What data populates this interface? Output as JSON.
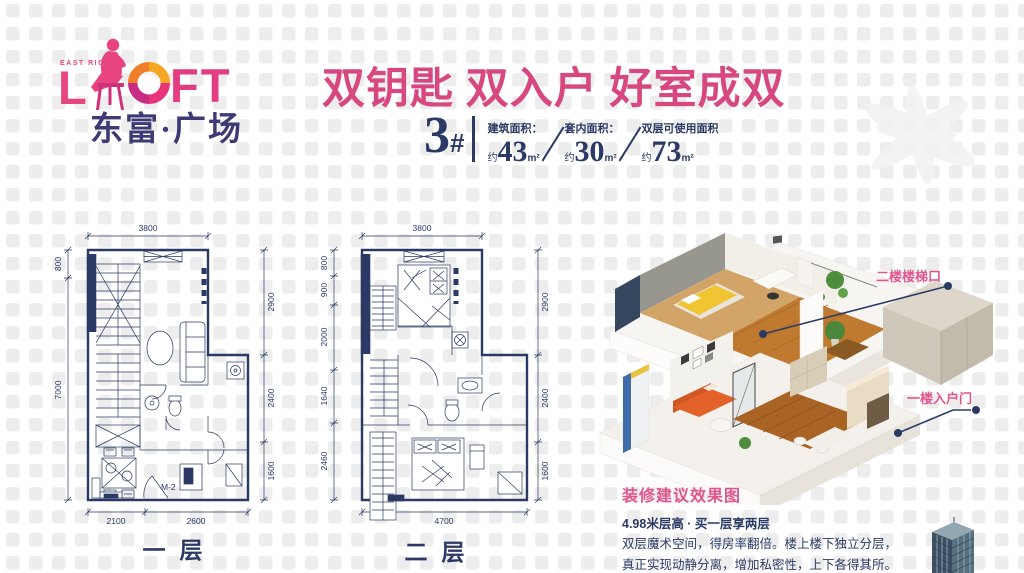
{
  "brand": {
    "east_rich": "EAST RICH",
    "loft_l": "L",
    "loft_o": "O",
    "loft_ft": "FT",
    "name_cn": "东富·广场"
  },
  "header": {
    "title": "双钥匙 双入户 好室成双",
    "unit_number": "3",
    "unit_hash": "#",
    "stats": [
      {
        "label": "建筑面积：",
        "prefix": "约",
        "value": "43",
        "unit": "m²"
      },
      {
        "label": "套内面积：",
        "prefix": "约",
        "value": "30",
        "unit": "m²"
      },
      {
        "label": "双层可使用面积",
        "prefix": "约",
        "value": "73",
        "unit": "m²"
      }
    ]
  },
  "floorplans": [
    {
      "name": "一层",
      "door_label": "M-2",
      "dims": {
        "top": "3800",
        "left": [
          "800",
          "7000"
        ],
        "right": [
          "2900",
          "2400",
          "1600"
        ],
        "bottom": [
          "2100",
          "2600"
        ]
      }
    },
    {
      "name": "二层",
      "dims": {
        "top": "3800",
        "left": [
          "800",
          "900",
          "2000",
          "1640",
          "2460"
        ],
        "right": [
          "2900",
          "2400",
          "1600"
        ],
        "bottom": [
          "4700"
        ]
      }
    }
  ],
  "render": {
    "callout_upper": "二楼楼梯口",
    "callout_lower": "一楼入户门",
    "caption_title": "装修建议效果图",
    "caption_subtitle": "4.98米层高 · 买一层享两层",
    "caption_line1": "双层魔术空间，得房率翻倍。楼上楼下独立分层，",
    "caption_line2": "真正实现动静分离，增加私密性，上下各得其所。"
  },
  "colors": {
    "navy": "#2b3a64",
    "title_pink": "#d6487f",
    "accent_pink": "#e0558c",
    "logo_pink": "#e8457f",
    "logo_orange": "#f08c28",
    "logo_indigo": "#3d3a75"
  }
}
